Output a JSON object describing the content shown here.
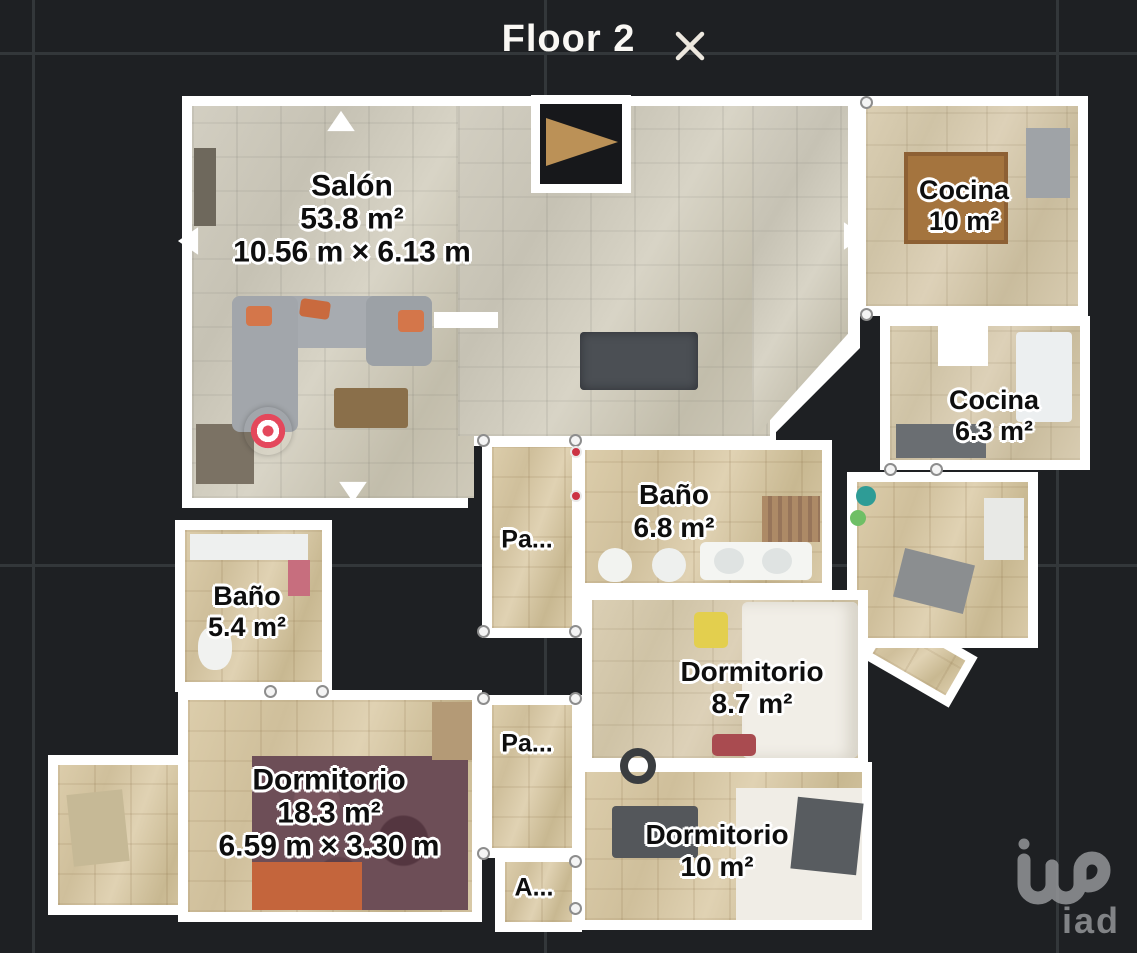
{
  "header": {
    "title": "Floor 2",
    "close_icon": "close"
  },
  "rooms": [
    {
      "id": "salon",
      "name": "Salón",
      "area": "53.8 m²",
      "dimensions": "10.56 m × 6.13 m"
    },
    {
      "id": "cocina-grande",
      "name": "Cocina",
      "area": "10 m²"
    },
    {
      "id": "cocina-pequena",
      "name": "Cocina",
      "area": "6.3 m²"
    },
    {
      "id": "bano-grande",
      "name": "Baño",
      "area": "6.8 m²"
    },
    {
      "id": "pasillo-1",
      "name": "Pa..."
    },
    {
      "id": "bano-pequeno",
      "name": "Baño",
      "area": "5.4 m²"
    },
    {
      "id": "dormitorio-medio",
      "name": "Dormitorio",
      "area": "8.7 m²"
    },
    {
      "id": "pasillo-2",
      "name": "Pa..."
    },
    {
      "id": "dormitorio-principal",
      "name": "Dormitorio",
      "area": "18.3 m²",
      "dimensions": "6.59 m × 3.30 m"
    },
    {
      "id": "dormitorio-pequeno",
      "name": "Dormitorio",
      "area": "10 m²"
    },
    {
      "id": "armario",
      "name": "A..."
    }
  ],
  "markers": {
    "position_marker_color": "#e4485c",
    "nav_arrows": [
      "up",
      "down",
      "left",
      "right"
    ]
  },
  "watermark": {
    "logo_text": "iad"
  },
  "colors": {
    "background": "#1e2023",
    "grid_line": "#33373a",
    "wall": "#ffffff",
    "title_text": "#faf8f4"
  }
}
